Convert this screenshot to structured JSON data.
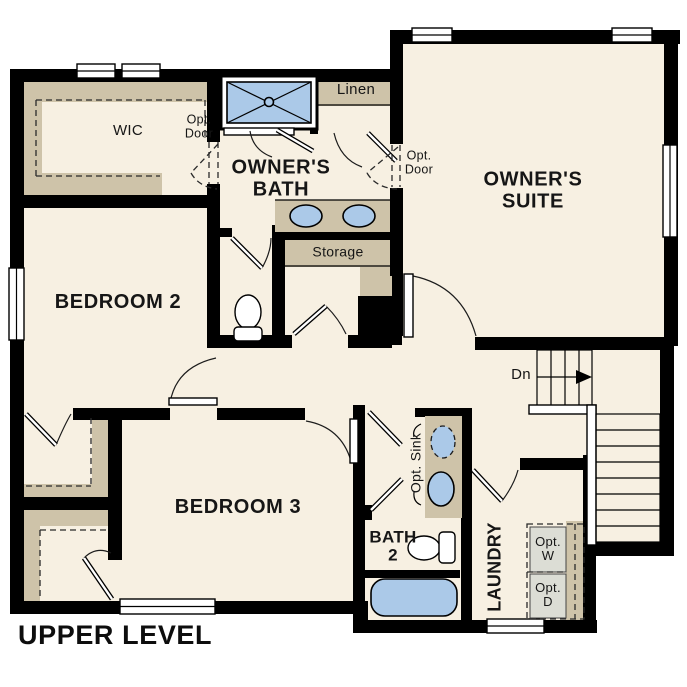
{
  "plan": {
    "title": "UPPER LEVEL",
    "labels": {
      "wic_top": "WIC",
      "wic_mid": "WIC",
      "wic_bottom": "WIC",
      "opt_door_wic": "Opt.\nDoor",
      "opt_door_suite": "Opt.\nDoor",
      "owners_bath": "OWNER'S\nBATH",
      "linen": "Linen",
      "owners_suite": "OWNER'S\nSUITE",
      "bedroom_2": "BEDROOM 2",
      "storage": "Storage",
      "down": "Dn",
      "bedroom_3": "BEDROOM 3",
      "opt_sink": "Opt. Sink",
      "bath_2": "BATH\n2",
      "laundry": "LAUNDRY",
      "opt_washer": "Opt.\nW",
      "opt_dryer": "Opt.\nD"
    },
    "colors": {
      "wall": "#000000",
      "floor": "#f7f0e2",
      "shelf": "#cec3a9",
      "fixture_blue": "#abc9e8",
      "appliance_grey": "#dcddd5",
      "outside": "#ffffff"
    }
  }
}
